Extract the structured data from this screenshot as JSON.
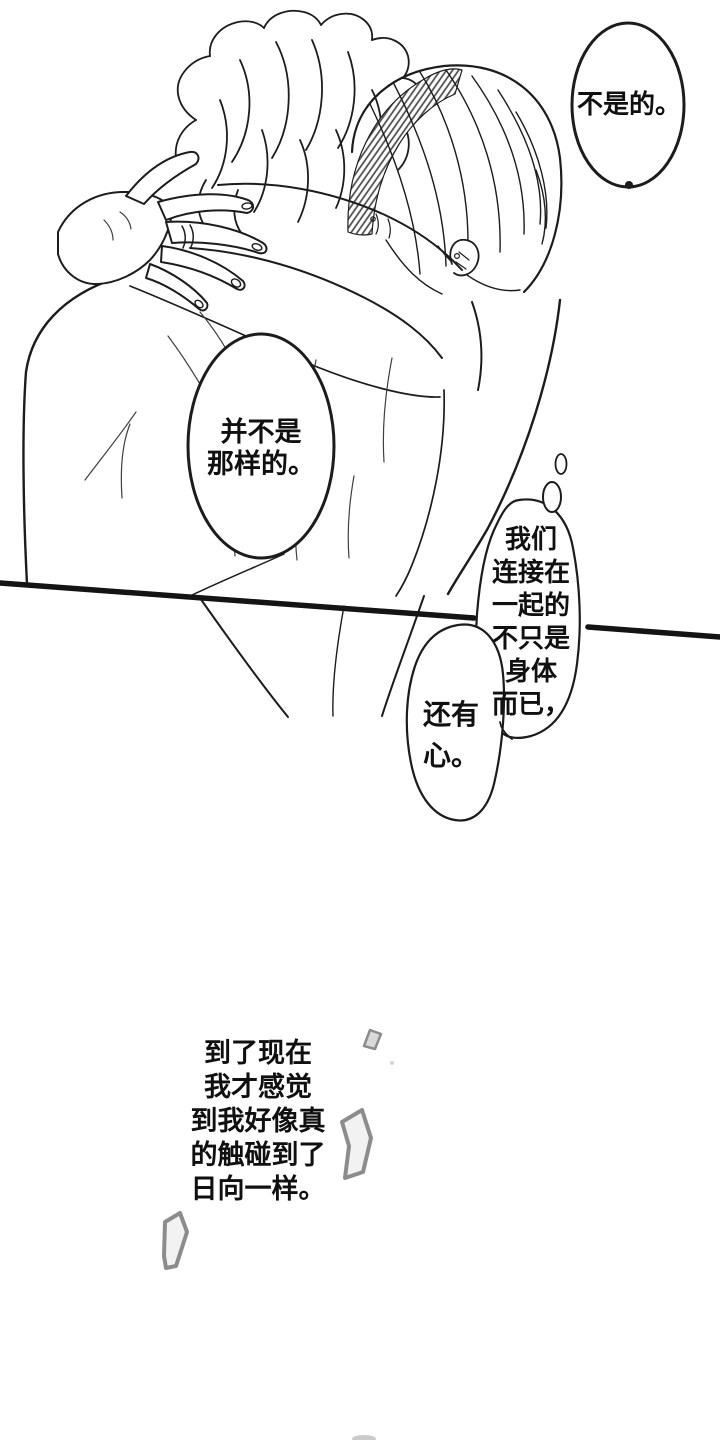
{
  "colors": {
    "ink": "#1c1c1c",
    "tone_hatch": "#4a4a4a",
    "sparkle_gray": "#8c8c8c"
  },
  "bubbles": {
    "denial": {
      "text": "不是的。"
    },
    "clarify": {
      "lines": [
        "并不是",
        "那样的。"
      ]
    },
    "thought_main": {
      "lines": [
        "我们",
        "连接在",
        "一起的",
        "不只是",
        "身体",
        "而已，"
      ]
    },
    "thought_secondary": {
      "lines": [
        "还有",
        "心。"
      ]
    },
    "narration": {
      "lines": [
        "到了现在",
        "我才感觉",
        "到我好像真",
        "的触碰到了",
        "日向一样。"
      ]
    }
  }
}
